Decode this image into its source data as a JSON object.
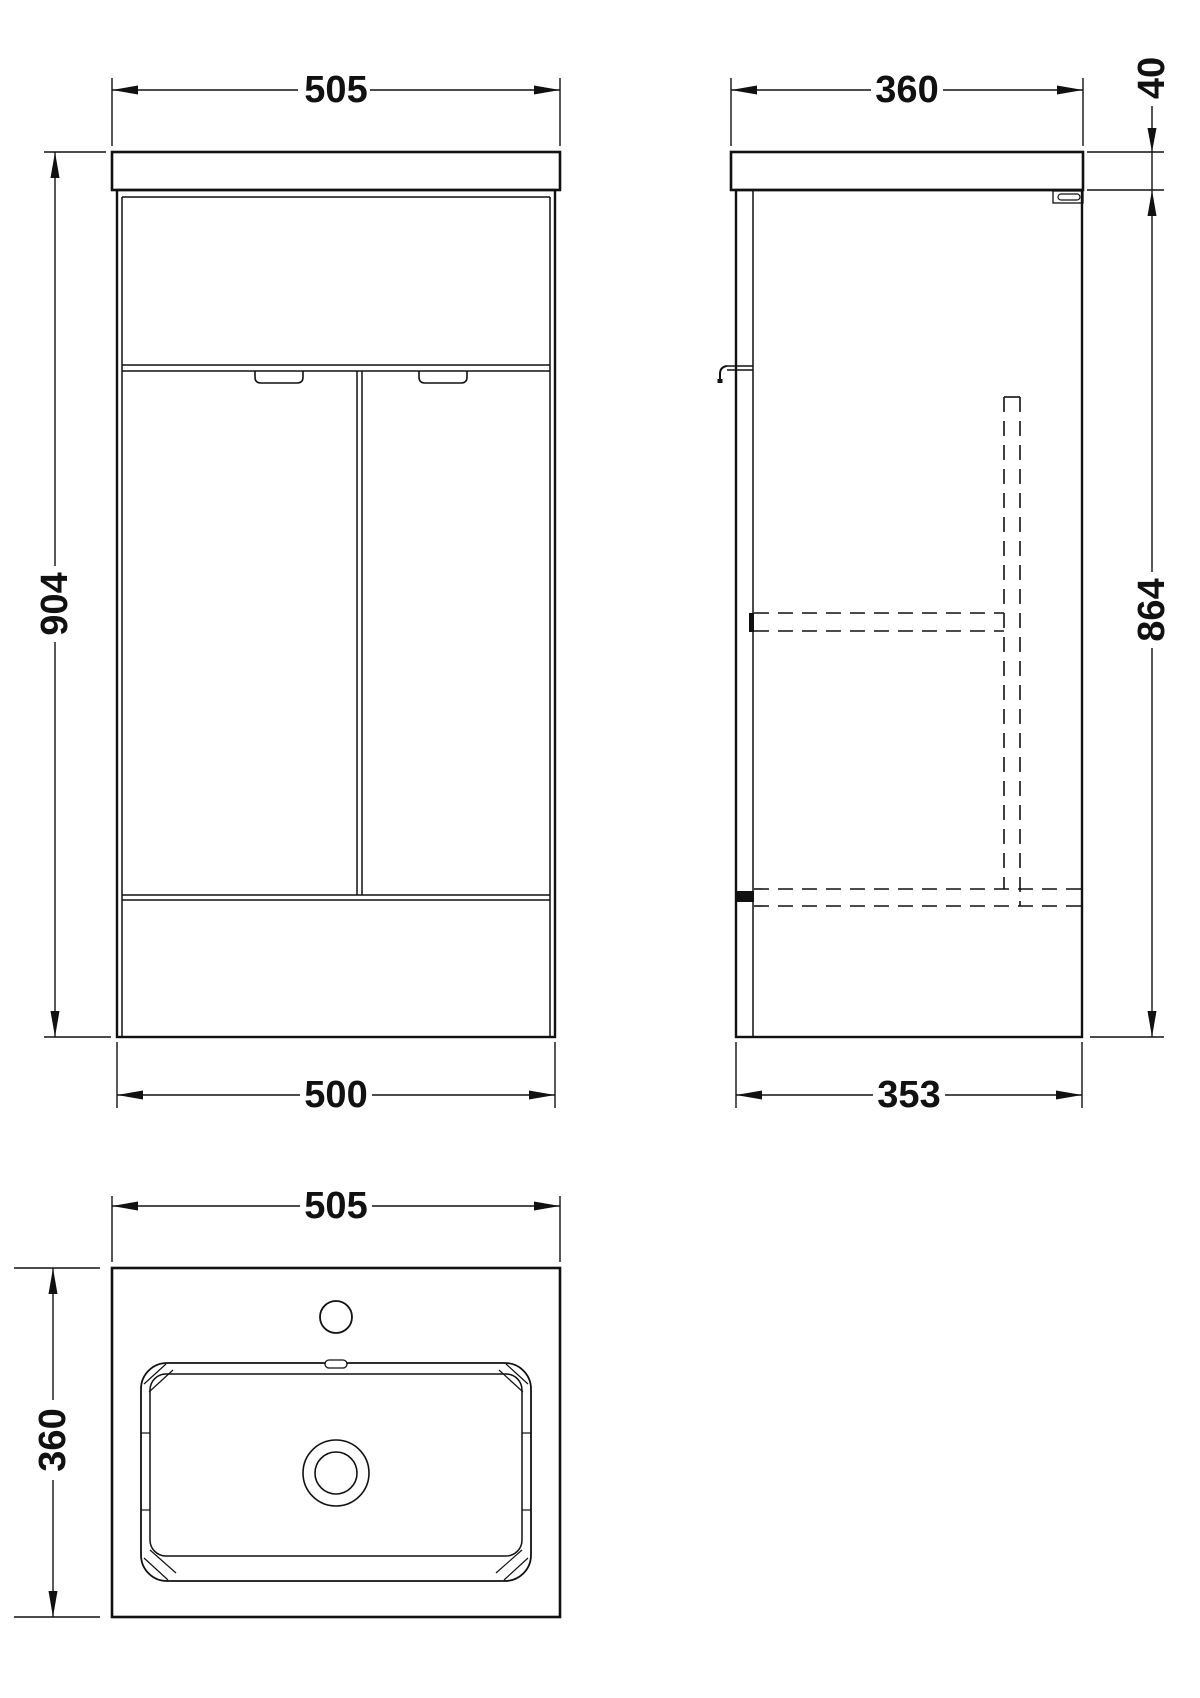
{
  "drawing": {
    "line_color": "#111111",
    "background_color": "#ffffff",
    "front_view": {
      "width_top": "505",
      "height": "904",
      "width_bottom": "500"
    },
    "side_view": {
      "depth_top": "360",
      "worktop_thickness": "40",
      "cabinet_height": "864",
      "depth_bottom": "353"
    },
    "plan_view": {
      "width": "505",
      "depth": "360"
    }
  }
}
